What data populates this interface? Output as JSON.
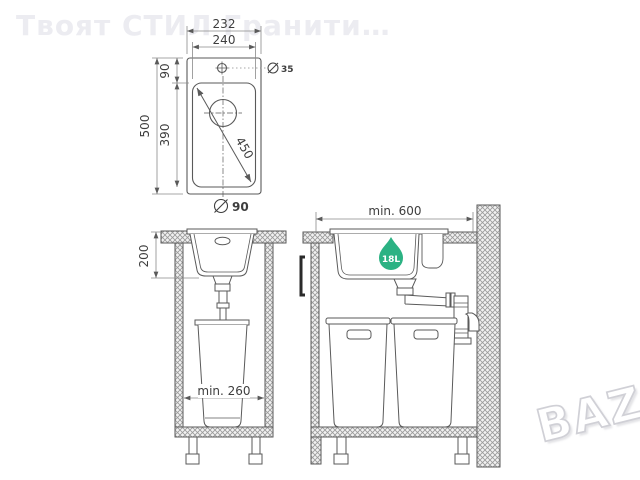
{
  "watermarks": {
    "seller": "Твоят СТИЛ Гранити…",
    "site": "BAZÂR"
  },
  "colors": {
    "line": "#5a5a5a",
    "dim_line": "#8a8a8a",
    "dim_text": "#3e3e3e",
    "hatch": "#9a9a9a",
    "badge_green": "#2bb283",
    "watermark_gray": "#ececf1"
  },
  "top_view": {
    "dim_width_overall": "232",
    "dim_width_bowl": "240",
    "dim_height_overall": "500",
    "dim_height_top": "90",
    "dim_height_bowl": "390",
    "dim_diagonal": "450",
    "faucet_hole_diameter": "35",
    "drain_diameter": "90"
  },
  "front_view": {
    "dim_bowl_depth": "200",
    "dim_min_cabinet_width": "min. 260"
  },
  "side_view": {
    "dim_min_cabinet_depth": "min. 600",
    "bowl_volume": "18L"
  }
}
